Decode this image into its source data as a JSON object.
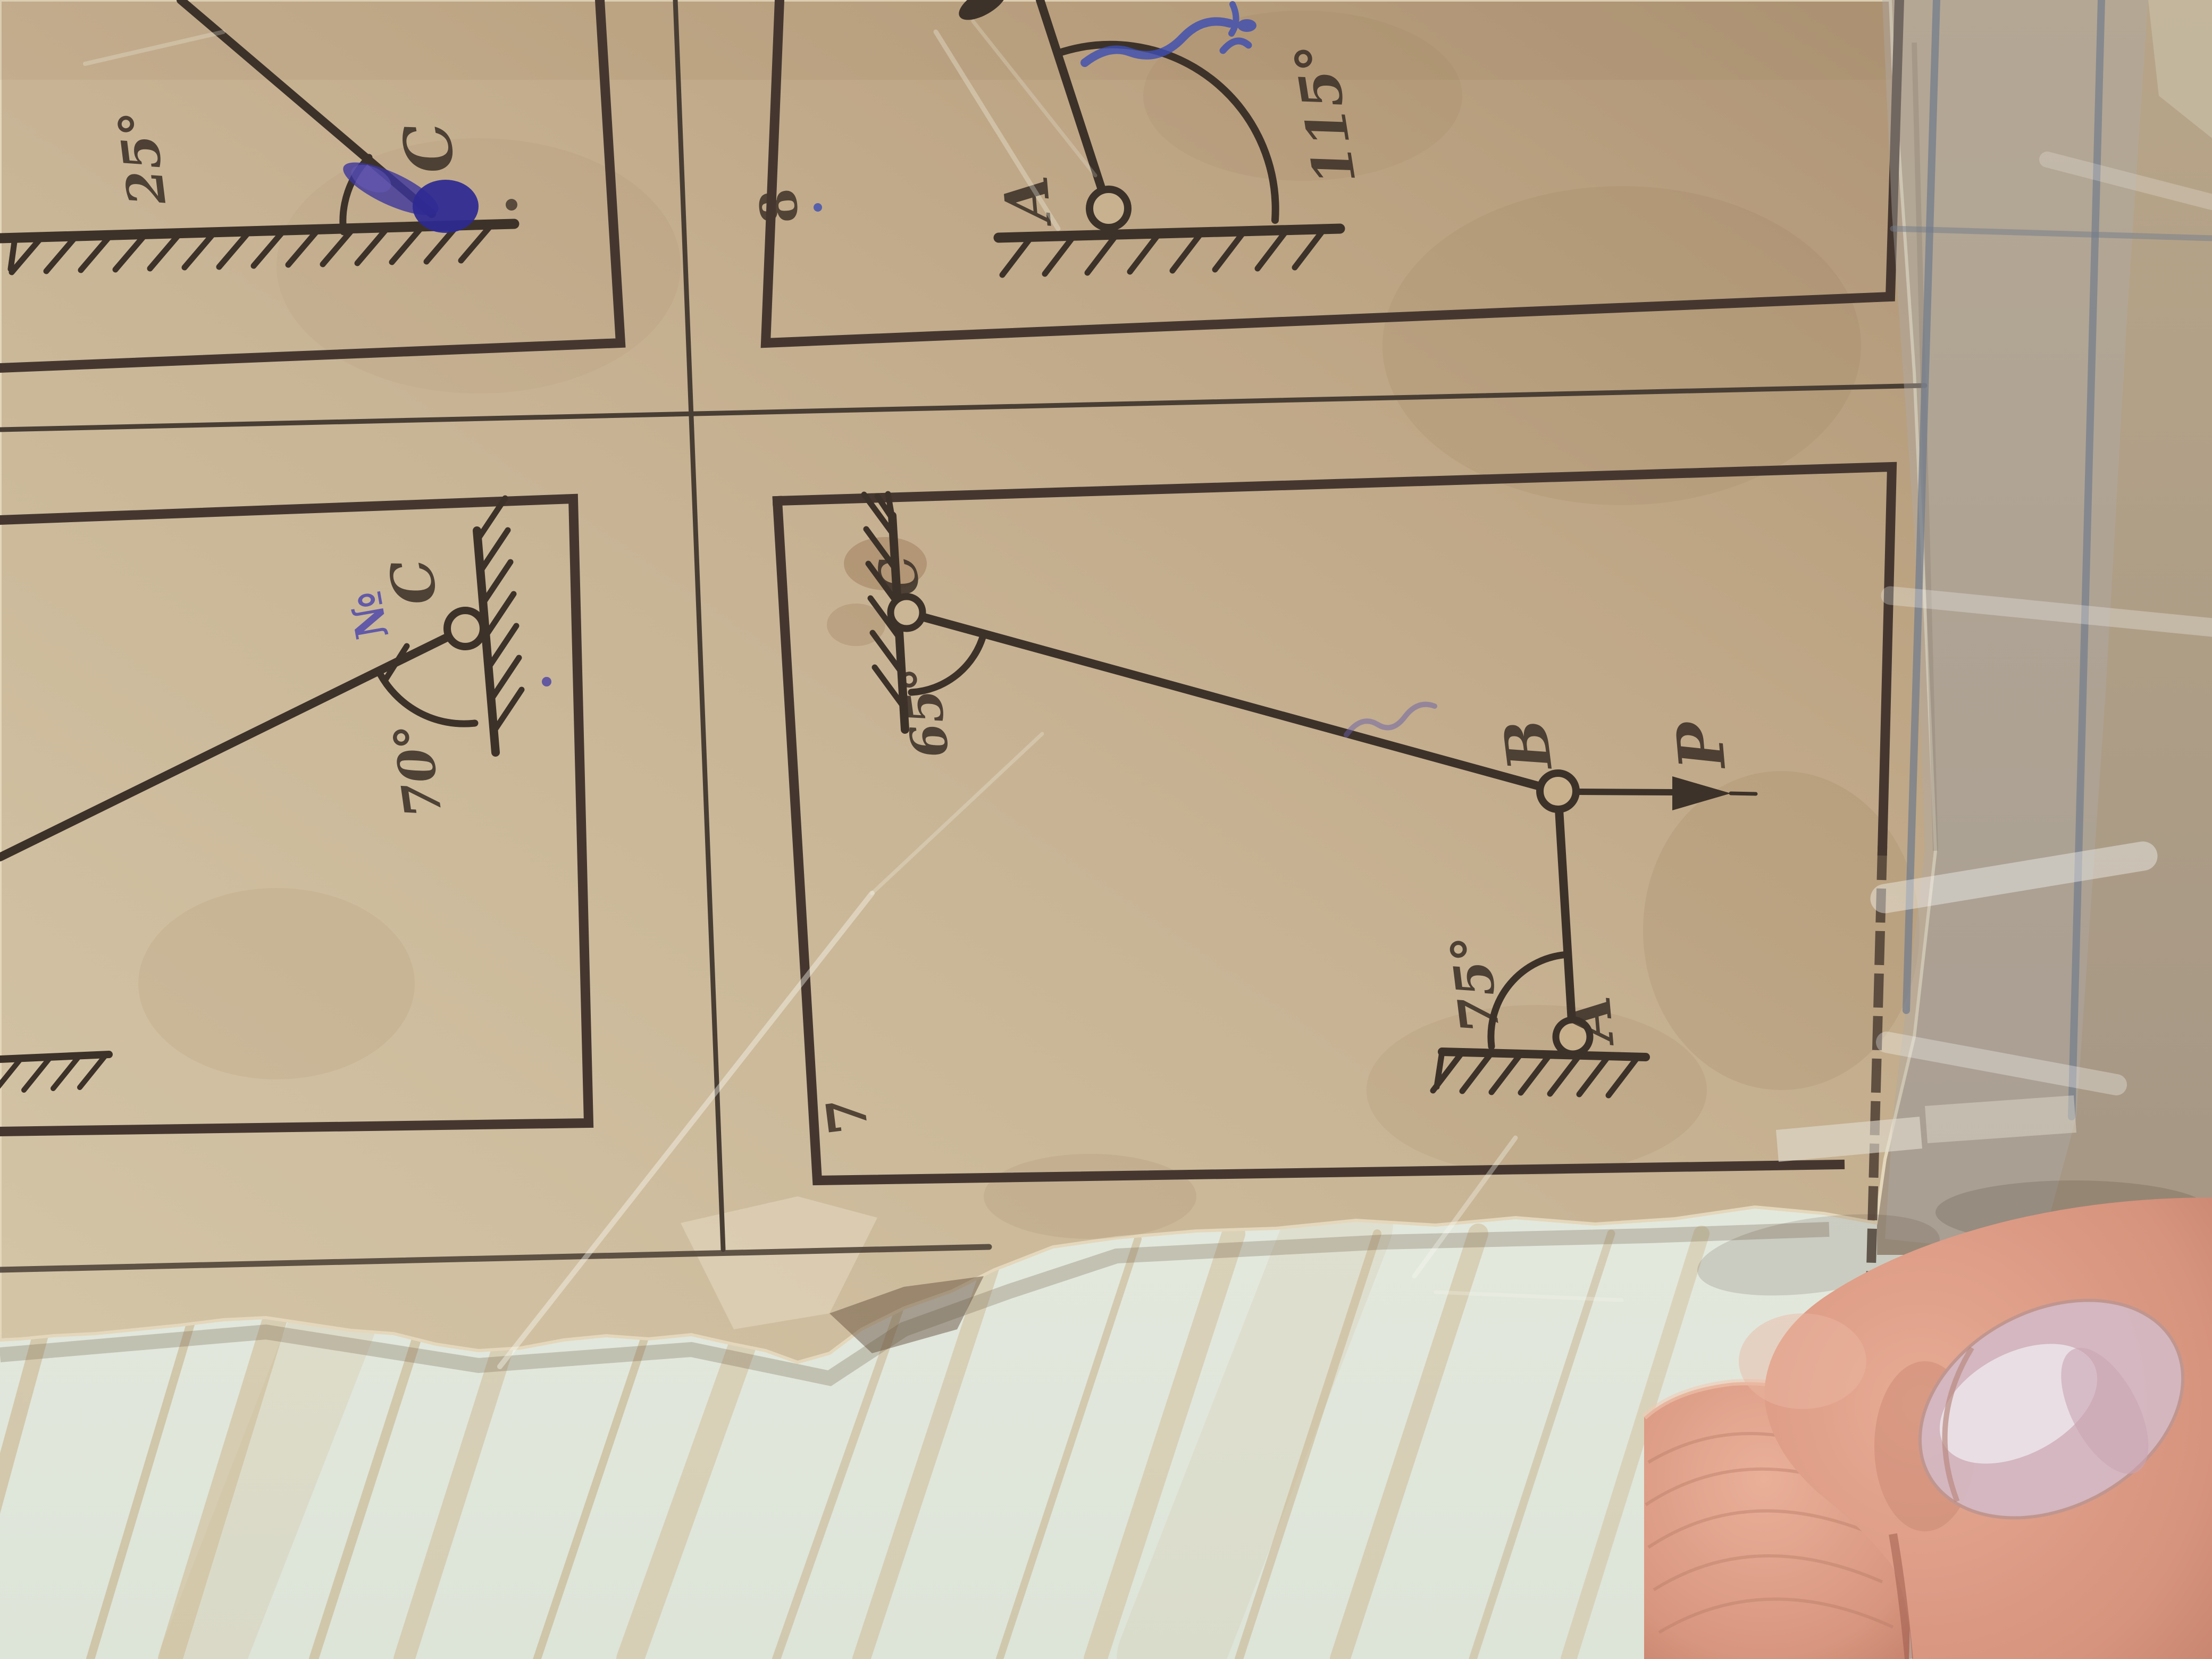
{
  "problems": {
    "tl": {
      "angle": "25°",
      "point_c": "C"
    },
    "p8": {
      "number": "8",
      "angle": "115°",
      "point_a": "A"
    },
    "ml": {
      "angle": "70°",
      "point_c": "C",
      "note": "№"
    },
    "p7": {
      "number": "7",
      "angle_c": "65°",
      "angle_a": "75°",
      "point_a": "A",
      "point_b": "B",
      "point_c": "C",
      "force": "P"
    }
  },
  "colors": {
    "ink": "#3f332a",
    "frame": "#473931",
    "paper_light": "#d9c9ab",
    "paper_dark": "#b29878",
    "blue_ink": "#3d37a0",
    "notebook_line": "#76808f",
    "wood": "#e6ece1",
    "wood_grain": "#cdb183",
    "skin": "#e0a28c",
    "nail": "#d9bcc6"
  }
}
